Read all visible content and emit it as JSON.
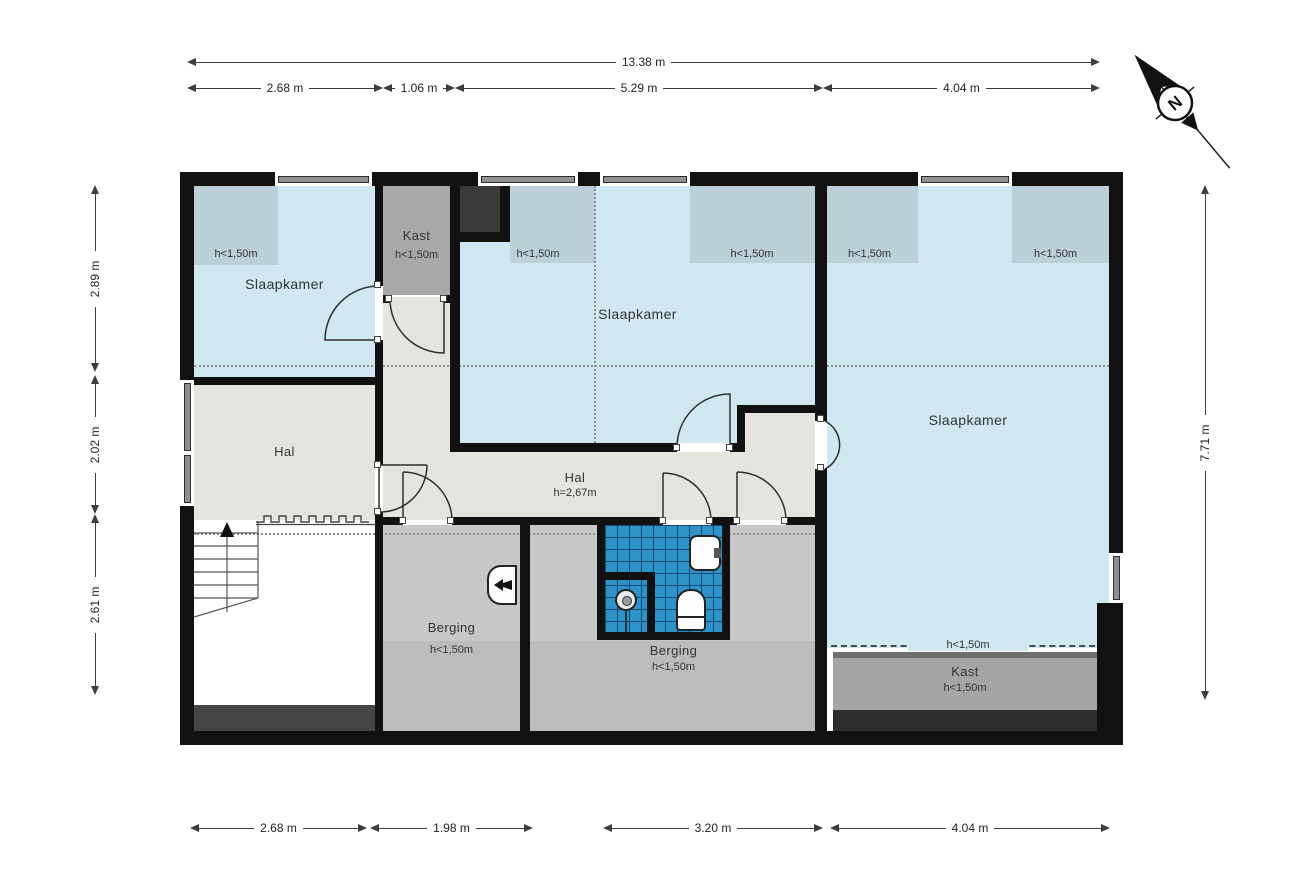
{
  "plan_type": "floorplan-second-floor",
  "compass": {
    "letter": "N"
  },
  "labels": {
    "slaapkamer_tl": "Slaapkamer",
    "slaapkamer_tl_note": "h<1,50m",
    "kast_top": "Kast",
    "kast_top_note": "h<1,50m",
    "slaapkamer_mid": "Slaapkamer",
    "slaapkamer_mid_note_left": "h<1,50m",
    "slaapkamer_mid_note_right": "h<1,50m",
    "slaapkamer_right": "Slaapkamer",
    "slaapkamer_right_note_left": "h<1,50m",
    "slaapkamer_right_note_right": "h<1,50m",
    "slaapkamer_right_note_bottom": "h<1,50m",
    "hal_left": "Hal",
    "hal_center": "Hal",
    "hal_center_height": "h=2,67m",
    "berging_left": "Berging",
    "berging_left_note": "h<1,50m",
    "berging_center": "Berging",
    "berging_center_note": "h<1,50m",
    "kast_bottom": "Kast",
    "kast_bottom_note": "h<1,50m"
  },
  "dims": {
    "total": "13.38 m",
    "top": [
      "2.68 m",
      "1.06 m",
      "5.29 m",
      "4.04 m"
    ],
    "bottom": [
      "2.68 m",
      "1.98 m",
      "3.20 m",
      "4.04 m"
    ],
    "left": [
      "2.89 m",
      "2.02 m",
      "2.61 m"
    ],
    "right": "7.71 m"
  },
  "colors": {
    "wall": "#111111",
    "room_blue": "#cfe8f2",
    "low_height_zone_blue": "#bcd0d9",
    "hall_gray": "#e5e4de",
    "storage_gray": "#c8c8c8",
    "closet_gray": "#a8a8a8",
    "tile_blue": "#2e93c8"
  }
}
